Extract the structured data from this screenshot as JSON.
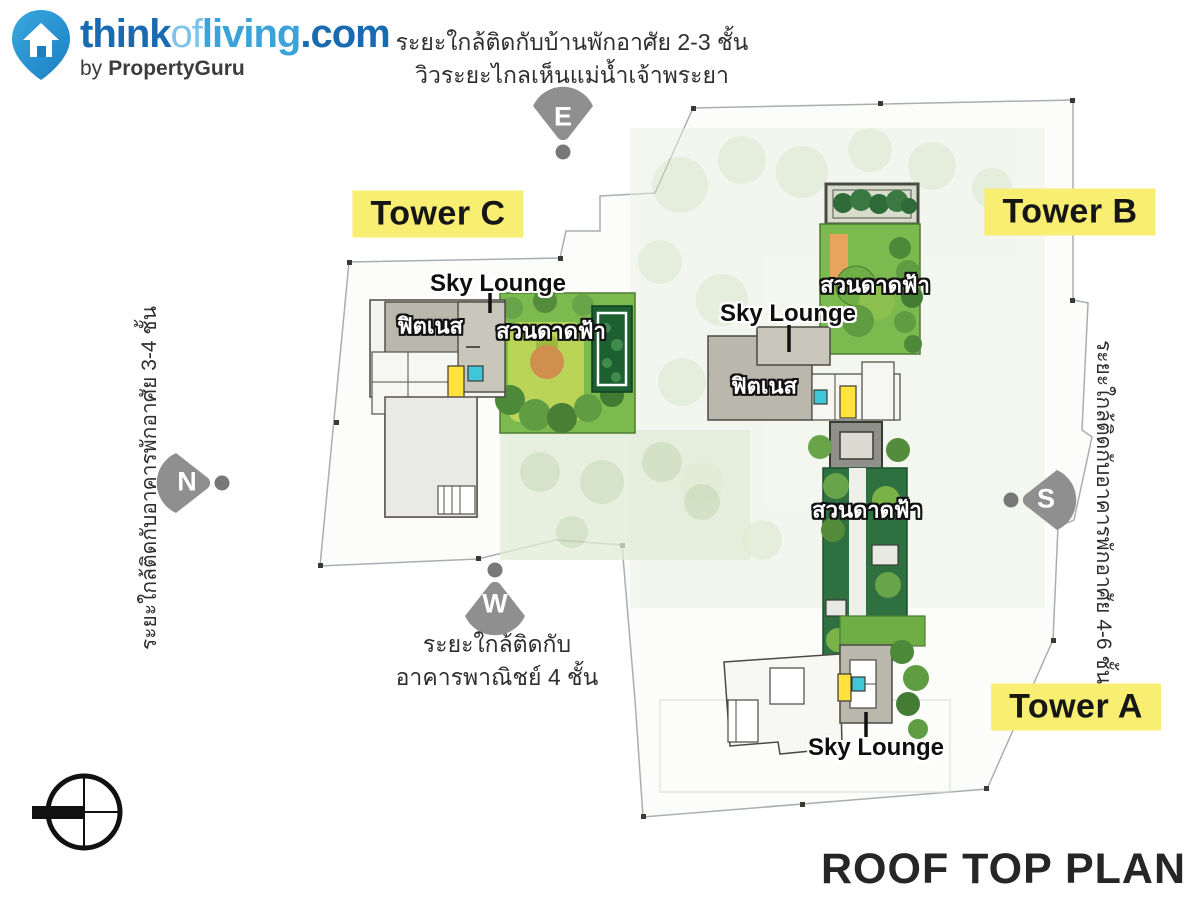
{
  "logo": {
    "brand": {
      "think": "think",
      "of": "of",
      "living": "living",
      "dotcom": ".com"
    },
    "tagline_by": "by",
    "tagline_brand": "PropertyGuru"
  },
  "title": "ROOF TOP PLAN",
  "direction_markers": {
    "east": "E",
    "west": "W",
    "north": "N",
    "south": "S"
  },
  "towers": {
    "a": "Tower A",
    "b": "Tower B",
    "c": "Tower C"
  },
  "facilities": {
    "sky_lounge": "Sky Lounge",
    "fitness": "ฟิตเนส",
    "roof_garden": "สวนดาดฟ้า"
  },
  "notes": {
    "top_line1": "ระยะใกล้ติดกับบ้านพักอาศัย 2-3 ชั้น",
    "top_line2": "วิวระยะไกลเห็นแม่น้ำเจ้าพระยา",
    "left": "ระยะใกล้ติดกับอาคารพักอาศัย 3-4 ชั้น",
    "right": "ระยะใกล้ติดกับอาคารพักอาศัย 4-6 ชั้น",
    "bottom_line1": "ระยะใกล้ติดกับ",
    "bottom_line2": "อาคารพาณิชย์ 4 ชั้น"
  },
  "icons": {
    "logo_pin": "house-location-pin",
    "compass": "north-arrow-compass",
    "direction_fan": "direction-fan-marker"
  },
  "colors": {
    "label_yellow": "#f7ee72",
    "logo_blue_dark": "#1a6ab1",
    "logo_blue_light": "#3ca3da",
    "roof_gray": "#bab7ad",
    "garden_green": "#7cb94e",
    "planter_dark_green": "#1d5f31",
    "elevator_yellow": "#ffe23c",
    "pool_cyan": "#3fc6d8",
    "marker_gray": "#8f8f8f",
    "path_orange": "#e8a35c",
    "title_black": "#262626"
  }
}
